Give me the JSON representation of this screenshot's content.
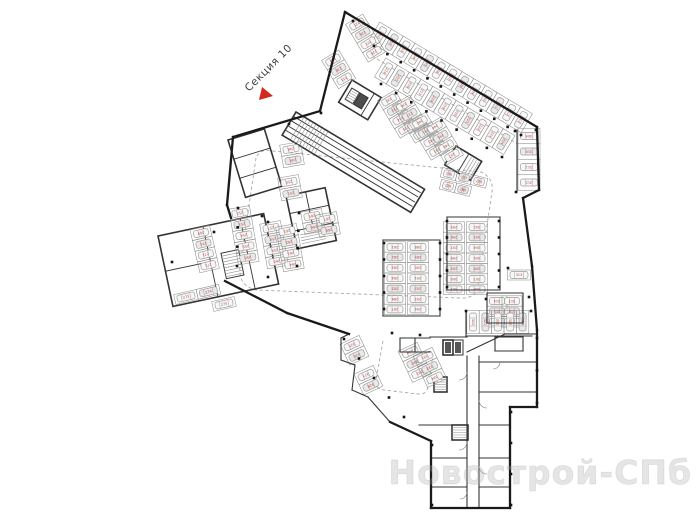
{
  "page": {
    "width": 700,
    "height": 525,
    "background": "#ffffff"
  },
  "section_label": {
    "text": "Секция 10",
    "color": "#3d3d3d"
  },
  "section_arrow": {
    "color": "#d3281e",
    "points": "262,87 259,100 273,96"
  },
  "watermark": {
    "text": "Новострой-СПб",
    "color": "rgba(170,170,170,0.30)",
    "stroke": "rgba(150,150,150,0.22)"
  },
  "colors": {
    "wall": "#1a1a1a",
    "inner_wall": "#333333",
    "stall_line": "#8c8c8c",
    "car_line": "#9b9b9b",
    "car_fill_a": "#f7f7f7",
    "car_fill_b": "#e9e9e9",
    "number": "#c2443c",
    "column": "#141414",
    "dash": "#a8a8a8",
    "arc": "#777777",
    "hatch": "#8f8f8f",
    "core_fill": "#4d4d4d"
  },
  "plan": {
    "start_number": 201,
    "outer_walls": [
      [
        345,
        12,
        537,
        127
      ],
      [
        537,
        127,
        539,
        190
      ],
      [
        539,
        190,
        523,
        198
      ],
      [
        523,
        198,
        532,
        266
      ],
      [
        532,
        266,
        537,
        330
      ],
      [
        537,
        330,
        537,
        407
      ],
      [
        537,
        407,
        510,
        407
      ],
      [
        510,
        407,
        510,
        508
      ],
      [
        510,
        508,
        431,
        508
      ],
      [
        431,
        508,
        431,
        441
      ],
      [
        431,
        441,
        390,
        422
      ],
      [
        349,
        334,
        287,
        313
      ],
      [
        287,
        313,
        225,
        281
      ],
      [
        345,
        12,
        320,
        111
      ],
      [
        320,
        111,
        233,
        137
      ],
      [
        233,
        137,
        227,
        205
      ],
      [
        227,
        205,
        231,
        218
      ]
    ],
    "inner_walls": [
      [
        430,
        337,
        467,
        337
      ],
      [
        467,
        352,
        505,
        334
      ],
      [
        505,
        334,
        536,
        334
      ],
      [
        467,
        356,
        467,
        508
      ],
      [
        479,
        356,
        479,
        508
      ],
      [
        479,
        362,
        536,
        362
      ],
      [
        479,
        392,
        536,
        392
      ],
      [
        479,
        425,
        510,
        425
      ],
      [
        479,
        458,
        510,
        458
      ],
      [
        479,
        487,
        510,
        487
      ],
      [
        419,
        425,
        467,
        425
      ],
      [
        431,
        458,
        467,
        458
      ],
      [
        431,
        487,
        467,
        487
      ],
      [
        495,
        337,
        523,
        337
      ],
      [
        495,
        337,
        495,
        351
      ],
      [
        523,
        337,
        523,
        351
      ],
      [
        495,
        351,
        523,
        351
      ],
      [
        383,
        240,
        440,
        240
      ],
      [
        383,
        316,
        440,
        316
      ],
      [
        383,
        240,
        383,
        316
      ],
      [
        440,
        240,
        440,
        316
      ],
      [
        447,
        217,
        500,
        217
      ],
      [
        447,
        290,
        500,
        290
      ],
      [
        447,
        217,
        447,
        290
      ],
      [
        500,
        217,
        500,
        290
      ],
      [
        466,
        336,
        532,
        336
      ],
      [
        466,
        311,
        466,
        336
      ],
      [
        487,
        293,
        523,
        293
      ],
      [
        487,
        293,
        487,
        323
      ],
      [
        523,
        293,
        523,
        323
      ],
      [
        487,
        323,
        523,
        323
      ],
      [
        517,
        130,
        517,
        192
      ],
      [
        400,
        338,
        430,
        338
      ],
      [
        400,
        338,
        400,
        352
      ],
      [
        400,
        352,
        430,
        352
      ],
      [
        415,
        338,
        415,
        352
      ],
      [
        341,
        338,
        341,
        360
      ],
      [
        341,
        360,
        355,
        365
      ],
      [
        355,
        365,
        352,
        390
      ],
      [
        352,
        390,
        368,
        397
      ],
      [
        368,
        397,
        390,
        422
      ],
      [
        349,
        334,
        341,
        338
      ]
    ],
    "groups": [
      {
        "name": "upper-left-rooms",
        "tx": 228,
        "ty": 140,
        "rot": -17,
        "rects": [
          [
            0,
            0,
            38,
            60
          ]
        ],
        "lines": [
          [
            0,
            20,
            38,
            20
          ],
          [
            0,
            40,
            38,
            40
          ]
        ],
        "stripes": [],
        "fills": []
      },
      {
        "name": "left-wing-rooms",
        "tx": 158,
        "ty": 236,
        "rot": -12,
        "rects": [
          [
            0,
            0,
            108,
            72
          ],
          [
            58,
            30,
            18,
            26
          ]
        ],
        "lines": [
          [
            46,
            0,
            46,
            72
          ],
          [
            0,
            36,
            46,
            36
          ],
          [
            84,
            0,
            84,
            72
          ]
        ],
        "stripes": [
          [
            58,
            30,
            18,
            26,
            3,
            "h"
          ]
        ],
        "fills": []
      },
      {
        "name": "center-rooms",
        "tx": 286,
        "ty": 196,
        "rot": -12,
        "rects": [
          [
            0,
            0,
            40,
            54
          ]
        ],
        "lines": [
          [
            20,
            0,
            20,
            36
          ],
          [
            0,
            18,
            40,
            18
          ],
          [
            0,
            36,
            40,
            36
          ]
        ],
        "stripes": [
          [
            6,
            38,
            24,
            14,
            3,
            "h"
          ]
        ],
        "fills": []
      },
      {
        "name": "garage-core",
        "tx": 352,
        "ty": 80,
        "rot": 31,
        "rects": [
          [
            0,
            0,
            34,
            26
          ],
          [
            4,
            7,
            9,
            13
          ],
          [
            14,
            7,
            9,
            13
          ]
        ],
        "lines": [
          [
            26,
            0,
            26,
            26
          ]
        ],
        "stripes": [
          [
            4,
            7,
            9,
            13,
            2.5,
            "h"
          ]
        ],
        "fills": [
          [
            14,
            7,
            9,
            13,
            "#4d4d4d"
          ]
        ]
      },
      {
        "name": "entry-ramp",
        "tx": 296,
        "ty": 112,
        "rot": 31,
        "rects": [
          [
            0,
            0,
            150,
            27
          ]
        ],
        "lines": [
          [
            0,
            5,
            148,
            5
          ],
          [
            0,
            10,
            148,
            10
          ],
          [
            0,
            16,
            148,
            16
          ],
          [
            0,
            21,
            148,
            21
          ]
        ],
        "stripes": [
          [
            6,
            1,
            34,
            25,
            3.5,
            "v"
          ]
        ],
        "fills": []
      },
      {
        "name": "tech-room",
        "tx": 456,
        "ty": 146,
        "rot": 31,
        "rects": [
          [
            0,
            0,
            30,
            22
          ]
        ],
        "lines": [
          [
            15,
            0,
            15,
            22
          ]
        ],
        "stripes": [
          [
            16,
            2,
            13,
            19,
            3,
            "v"
          ]
        ],
        "fills": []
      },
      {
        "name": "elevator-core",
        "tx": 443,
        "ty": 340,
        "rot": 0,
        "rects": [
          [
            0,
            0,
            10,
            15
          ],
          [
            10,
            0,
            10,
            15
          ]
        ],
        "lines": [],
        "stripes": [],
        "fills": [
          [
            2,
            2,
            6,
            11,
            "#555555"
          ],
          [
            12,
            2,
            6,
            11,
            "#555555"
          ]
        ]
      },
      {
        "name": "stair-core-1",
        "tx": 434,
        "ty": 377,
        "rot": 0,
        "rects": [
          [
            0,
            0,
            13,
            15
          ]
        ],
        "lines": [],
        "stripes": [
          [
            0,
            0,
            13,
            15,
            2.5,
            "h"
          ]
        ],
        "fills": []
      },
      {
        "name": "stair-core-2",
        "tx": 452,
        "ty": 425,
        "rot": 0,
        "rects": [
          [
            0,
            0,
            16,
            15
          ]
        ],
        "lines": [],
        "stripes": [
          [
            0,
            0,
            16,
            15,
            2.5,
            "h"
          ]
        ],
        "fills": []
      }
    ],
    "parking_rows": [
      {
        "x": 380,
        "y": 35,
        "angle": 31,
        "sw": 13.7,
        "sh": 22,
        "n": 13,
        "park": "perp"
      },
      {
        "x": 386,
        "y": 71,
        "angle": 31,
        "sw": 13.7,
        "sh": 22,
        "n": 11,
        "park": "perp"
      },
      {
        "x": 357,
        "y": 24,
        "angle": 59,
        "sw": 11,
        "sh": 20,
        "n": 4,
        "park": "perp"
      },
      {
        "x": 333,
        "y": 60,
        "angle": 59,
        "sw": 11,
        "sh": 20,
        "n": 3,
        "park": "perp"
      },
      {
        "x": 389,
        "y": 100,
        "angle": 59,
        "sw": 11,
        "sh": 20,
        "n": 4,
        "park": "perp"
      },
      {
        "x": 404,
        "y": 105,
        "angle": 59,
        "sw": 11,
        "sh": 20,
        "n": 4,
        "park": "perp"
      },
      {
        "x": 420,
        "y": 122,
        "angle": 59,
        "sw": 11,
        "sh": 20,
        "n": 4,
        "park": "perp"
      },
      {
        "x": 435,
        "y": 127,
        "angle": 59,
        "sw": 11,
        "sh": 20,
        "n": 4,
        "park": "perp"
      },
      {
        "x": 291,
        "y": 149,
        "angle": 80,
        "sw": 11.5,
        "sh": 21,
        "n": 2,
        "park": "perp"
      },
      {
        "x": 289,
        "y": 182,
        "angle": 80,
        "sw": 11.5,
        "sh": 21,
        "n": 2,
        "park": "perp"
      },
      {
        "x": 240,
        "y": 213,
        "angle": 80,
        "sw": 11.3,
        "sh": 21,
        "n": 5,
        "park": "perp"
      },
      {
        "x": 271,
        "y": 228,
        "angle": 80,
        "sw": 11.3,
        "sh": 21,
        "n": 4,
        "park": "perp"
      },
      {
        "x": 287,
        "y": 231,
        "angle": 80,
        "sw": 11.3,
        "sh": 21,
        "n": 4,
        "park": "perp"
      },
      {
        "x": 312,
        "y": 216,
        "angle": 80,
        "sw": 11.3,
        "sh": 21,
        "n": 2,
        "park": "perp"
      },
      {
        "x": 327,
        "y": 219,
        "angle": 80,
        "sw": 11.3,
        "sh": 21,
        "n": 2,
        "park": "perp"
      },
      {
        "x": 201,
        "y": 233,
        "angle": 77,
        "sw": 11,
        "sh": 20,
        "n": 4,
        "park": "perp"
      },
      {
        "x": 186,
        "y": 297,
        "angle": -13,
        "sw": 23,
        "sh": 10,
        "n": 2,
        "park": "par"
      },
      {
        "x": 224,
        "y": 304,
        "angle": -13,
        "sw": 23,
        "sh": 10,
        "n": 1,
        "park": "par"
      },
      {
        "x": 449,
        "y": 174,
        "angle": 14,
        "sw": 15.5,
        "sh": 10,
        "n": 3,
        "park": "par"
      },
      {
        "x": 448,
        "y": 186,
        "angle": 14,
        "sw": 15.5,
        "sh": 10,
        "n": 2,
        "park": "par"
      },
      {
        "x": 395,
        "y": 247,
        "angle": 90,
        "sw": 10.4,
        "sh": 21,
        "n": 7,
        "park": "perp"
      },
      {
        "x": 418,
        "y": 247,
        "angle": 90,
        "sw": 10.4,
        "sh": 21,
        "n": 7,
        "park": "perp"
      },
      {
        "x": 454,
        "y": 227,
        "angle": 90,
        "sw": 10.4,
        "sh": 21,
        "n": 7,
        "park": "perp"
      },
      {
        "x": 477,
        "y": 227,
        "angle": 90,
        "sw": 10.4,
        "sh": 21,
        "n": 7,
        "park": "perp"
      },
      {
        "x": 529,
        "y": 136,
        "angle": 90,
        "sw": 15.5,
        "sh": 22,
        "n": 4,
        "park": "perp"
      },
      {
        "x": 519,
        "y": 275,
        "angle": 0,
        "sw": 23,
        "sh": 10,
        "n": 1,
        "park": "par"
      },
      {
        "x": 497,
        "y": 301,
        "angle": 90,
        "sw": 10.4,
        "sh": 20,
        "n": 3,
        "park": "perp"
      },
      {
        "x": 512,
        "y": 301,
        "angle": 90,
        "sw": 10.4,
        "sh": 20,
        "n": 3,
        "park": "perp"
      },
      {
        "x": 473,
        "y": 322,
        "angle": 0,
        "sw": 12.4,
        "sh": 23,
        "n": 5,
        "park": "perp"
      },
      {
        "x": 352,
        "y": 345,
        "angle": 65,
        "sw": 11.5,
        "sh": 21,
        "n": 2,
        "park": "perp"
      },
      {
        "x": 366,
        "y": 375,
        "angle": 65,
        "sw": 11.5,
        "sh": 21,
        "n": 2,
        "park": "perp"
      },
      {
        "x": 410,
        "y": 352,
        "angle": 65,
        "sw": 11.5,
        "sh": 21,
        "n": 3,
        "park": "perp"
      },
      {
        "x": 425,
        "y": 357,
        "angle": 65,
        "sw": 11.5,
        "sh": 21,
        "n": 3,
        "park": "perp"
      }
    ],
    "column_lines": [
      [
        374,
        46,
        521,
        135,
        12
      ],
      [
        381,
        84,
        502,
        157,
        9
      ],
      [
        238,
        208,
        237,
        266,
        4
      ],
      [
        299,
        213,
        297,
        266,
        4
      ],
      [
        384,
        243,
        384,
        309,
        5
      ],
      [
        440,
        243,
        440,
        309,
        5
      ],
      [
        447,
        221,
        447,
        287,
        5
      ],
      [
        499,
        221,
        499,
        287,
        5
      ],
      [
        344,
        339,
        404,
        417,
        5
      ],
      [
        511,
        412,
        511,
        505,
        4
      ],
      [
        537,
        338,
        537,
        403,
        3
      ]
    ],
    "column_points": [
      [
        515,
        131
      ],
      [
        516,
        192
      ],
      [
        508,
        268
      ],
      [
        486,
        299
      ],
      [
        529,
        297
      ],
      [
        172,
        262
      ],
      [
        214,
        232
      ],
      [
        262,
        216
      ],
      [
        289,
        124
      ],
      [
        321,
        113
      ],
      [
        353,
        21
      ],
      [
        536,
        130
      ],
      [
        466,
        311
      ],
      [
        531,
        311
      ],
      [
        392,
        333
      ],
      [
        420,
        335
      ],
      [
        268,
        222
      ],
      [
        268,
        277
      ],
      [
        432,
        445
      ],
      [
        432,
        505
      ]
    ],
    "dashed_paths": [
      "M256,158 L240,266 Q238,286 256,290 L460,298 Q476,299 478,286 L492,192 Q494,178 481,172 L273,151 Q260,148 256,158 Z",
      "M372,56 L518,144",
      "M383,341 L376,380 Q375,389 384,390 L418,394 Q427,395 428,386 L433,355"
    ],
    "door_arcs": [
      "M467,372 a8,8 0 0 1 -8,8",
      "M479,400 a8,8 0 0 0 8,8",
      "M467,442 a8,8 0 0 1 -8,8",
      "M479,466 a8,8 0 0 0 8,8",
      "M500,362 a7,7 0 0 1 -7,7",
      "M467,492 a7,7 0 0 1 -7,7"
    ]
  }
}
